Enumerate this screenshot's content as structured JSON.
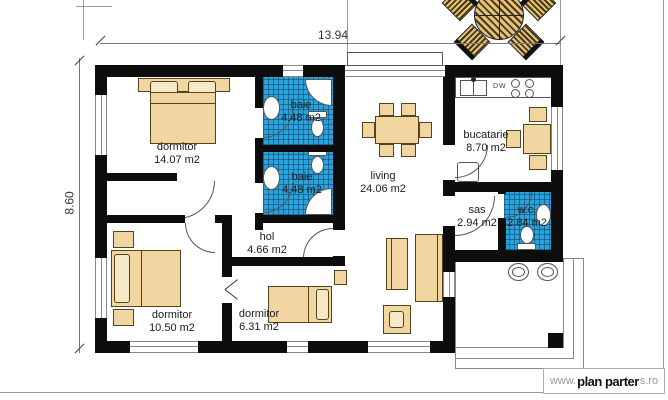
{
  "dimensions": {
    "width": "13.94",
    "height": "8.60"
  },
  "rooms": [
    {
      "name": "dormitor",
      "area": "14.07 m2"
    },
    {
      "name": "baie",
      "area": "4.48 m2"
    },
    {
      "name": "baie",
      "area": "4.48 m2"
    },
    {
      "name": "living",
      "area": "24.06 m2"
    },
    {
      "name": "bucatarie",
      "area": "8.70 m2"
    },
    {
      "name": "sas",
      "area": "2.94 m2"
    },
    {
      "name": "w.c.",
      "area": "2.84 m2"
    },
    {
      "name": "hol",
      "area": "4.66 m2"
    },
    {
      "name": "dormitor",
      "area": "10.50 m2"
    },
    {
      "name": "dormitor",
      "area": "6.31 m2"
    }
  ],
  "kitchen": {
    "dw_label": "DW"
  },
  "watermark": {
    "prefix": "www.",
    "brand": "plan parter",
    "suffix": "s.ro"
  },
  "colors": {
    "wall": "#0d0d0d",
    "bath_tile": "#2aa2da",
    "furniture": "#f1d6a2",
    "thin_line": "#8a8a8a"
  }
}
